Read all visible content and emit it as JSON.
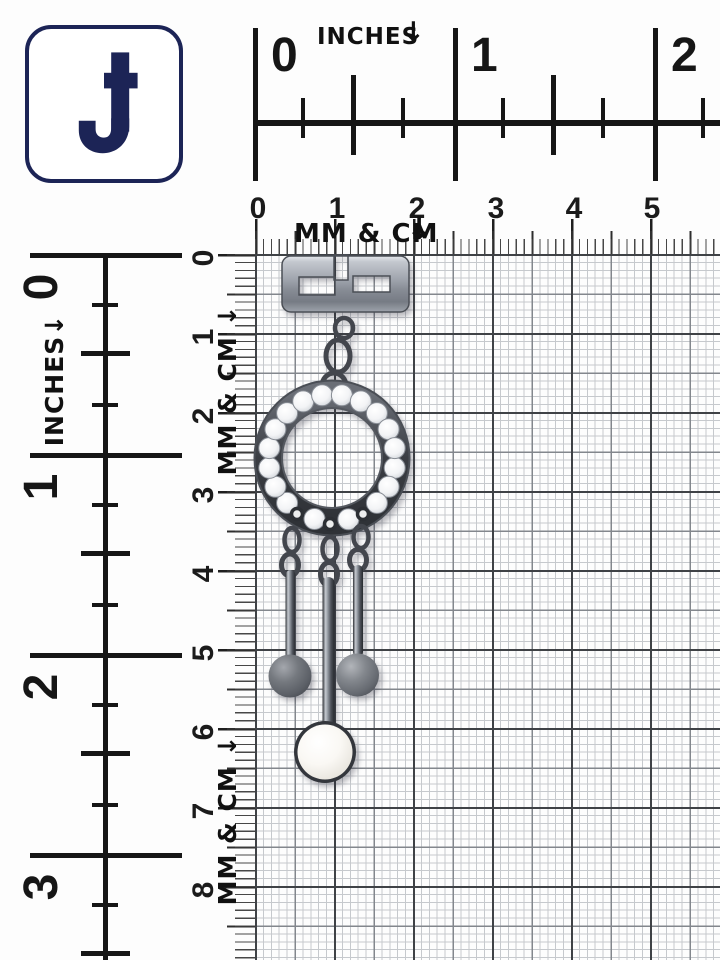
{
  "logo": {
    "letter": "J"
  },
  "rulers": {
    "top_inches": {
      "label": "INCHES",
      "arrow": "↓",
      "numbers": [
        "0",
        "1",
        "2"
      ]
    },
    "top_cm": {
      "numbers": [
        "0",
        "1",
        "2",
        "3",
        "4",
        "5"
      ],
      "label": "MM & CM",
      "arrow": "↓"
    },
    "left_inches": {
      "label": "INCHES↓",
      "numbers": [
        "0",
        "1",
        "2",
        "3"
      ]
    },
    "left_cm": {
      "numbers": [
        "0",
        "1",
        "2",
        "3",
        "4",
        "5",
        "6",
        "7",
        "8",
        "9"
      ],
      "label_upper": "MM & CM ↓",
      "label_lower": "MM & CM ↓"
    }
  },
  "jewelry": {
    "parts": [
      "greek-key-plaque",
      "chain-links",
      "crystal-studded-circle",
      "grey-bead-drop-left",
      "pearl-drop-center",
      "grey-bead-drop-right"
    ]
  },
  "colors": {
    "logo_navy": "#1c2456",
    "ruler_black": "#161616",
    "grid_mm": "#c6c9cd",
    "grid_5mm": "#83878d",
    "grid_cm": "#3f4246",
    "gunmetal": "#4a4e55",
    "pearl": "#f4f2ec",
    "bead_grey": "#7d8187"
  }
}
